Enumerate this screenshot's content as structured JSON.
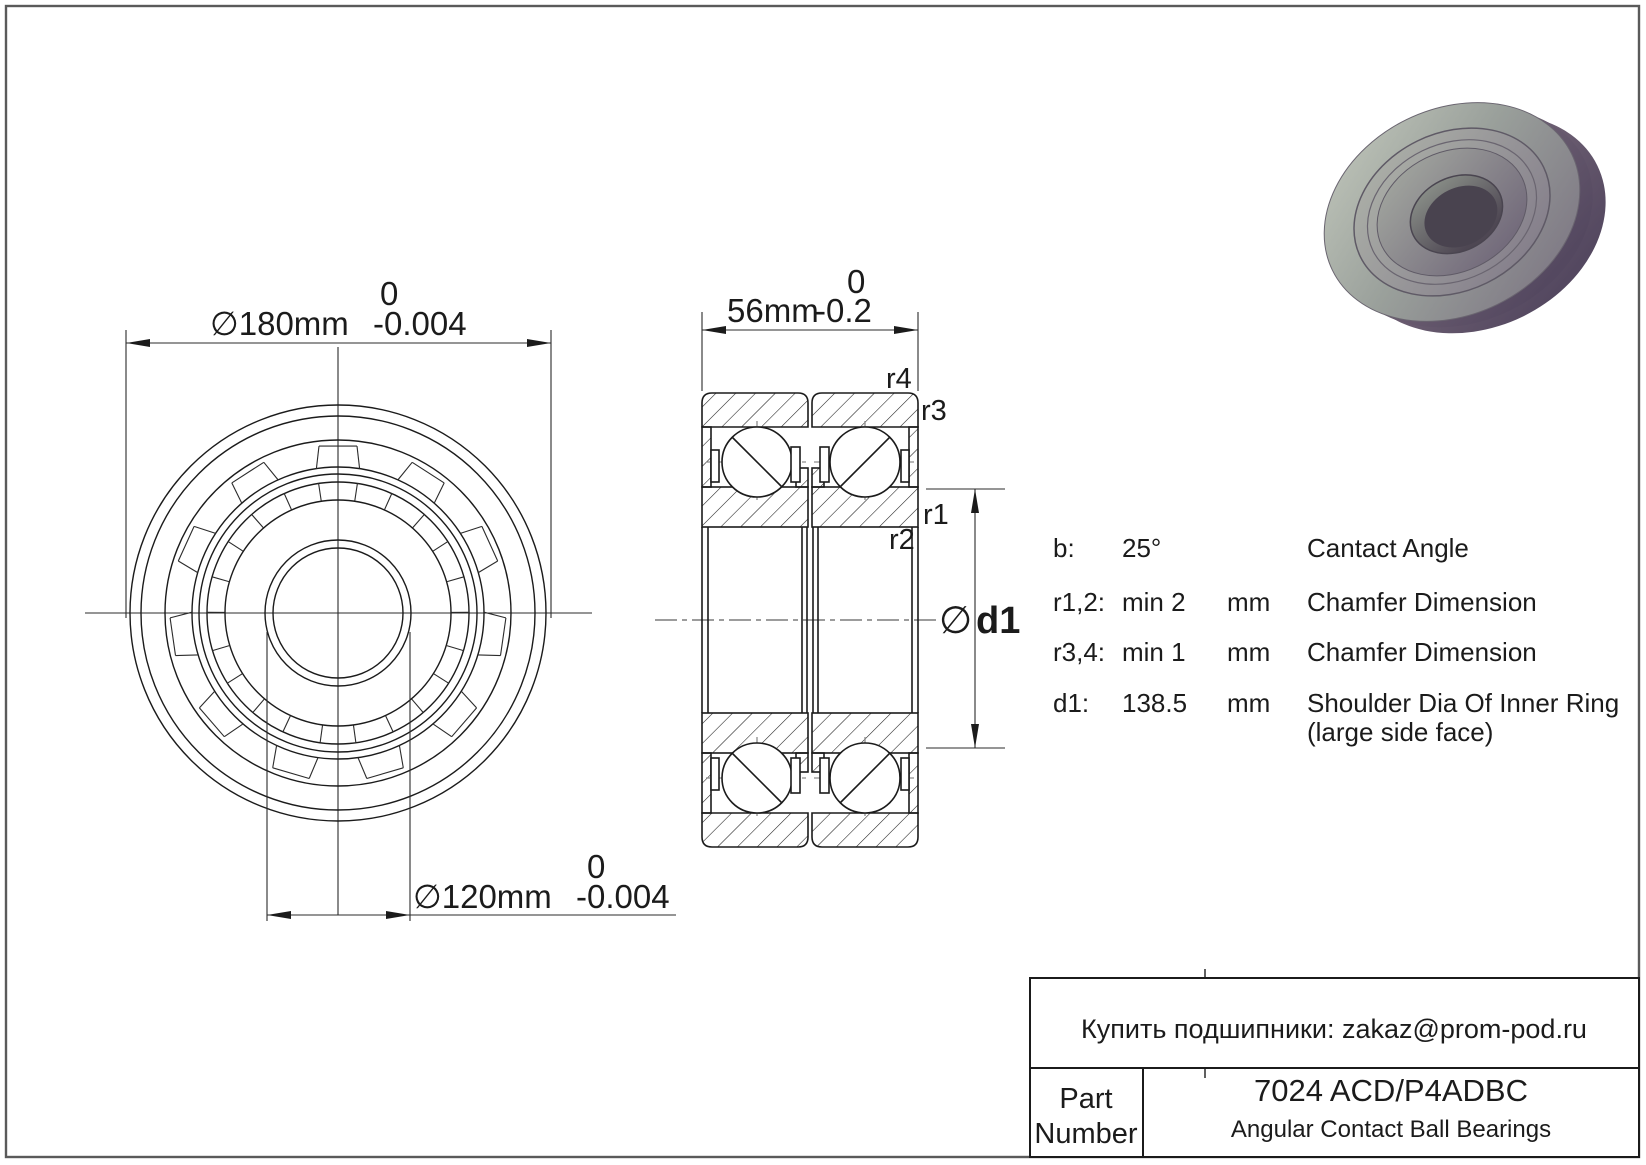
{
  "page": {
    "background": "#ffffff",
    "border_color": "#5a5a5a",
    "line_color": "#1b1b1b"
  },
  "front_view": {
    "od_dim": {
      "value": "∅180mm",
      "tol_top": "0",
      "tol_bottom": "-0.004"
    },
    "bore_dim": {
      "value": "∅120mm",
      "tol_top": "0",
      "tol_bottom": "-0.004"
    }
  },
  "section_view": {
    "width_dim": {
      "value": "56mm",
      "tol_top": "0",
      "tol_bottom": "-0.2"
    },
    "chamfer_labels": {
      "r1": "r1",
      "r2": "r2",
      "r3": "r3",
      "r4": "r4"
    },
    "shoulder_dim_prefix": "∅",
    "shoulder_dim_name": "d1"
  },
  "specs": {
    "rows": [
      {
        "key": "b:",
        "value": "25°",
        "unit": "",
        "desc": "Cantact Angle",
        "desc2": ""
      },
      {
        "key": "r1,2:",
        "value": "min 2",
        "unit": "mm",
        "desc": "Chamfer Dimension",
        "desc2": ""
      },
      {
        "key": "r3,4:",
        "value": "min 1",
        "unit": "mm",
        "desc": "Chamfer Dimension",
        "desc2": ""
      },
      {
        "key": "d1:",
        "value": "138.5",
        "unit": "mm",
        "desc": "Shoulder Dia Of Inner Ring",
        "desc2": "(large side face)"
      }
    ]
  },
  "title_block": {
    "contact_line": "Купить подшипники: zakaz@prom-pod.ru",
    "part_label_1": "Part",
    "part_label_2": "Number",
    "part_number": "7024 ACD/P4ADBC",
    "category": "Angular Contact Ball Bearings"
  }
}
